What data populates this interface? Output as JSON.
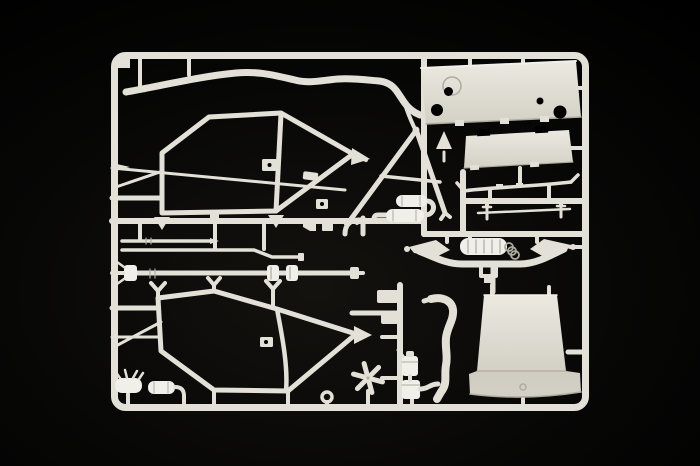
{
  "scene": {
    "type": "product-photograph",
    "description": "Injection-moulded model kit sprue (parts tree) in light ivory-grey styrene photographed on a black background; rounded rectangular runner frame with internal runners holding roll-cage frames, body panels, axle, driveshaft, exhaust and small fittings.",
    "colors": {
      "background": "#000000",
      "vignette": "#14120f",
      "plastic": "#e3e0d7",
      "plastic-bright": "#f1efe9",
      "plastic-dark": "#aeab9f",
      "panel-top": "#ebe9e0",
      "panel-bottom": "#d3d0c6",
      "skirt": "#cfccc2"
    },
    "frame": {
      "label": "Sprue runner frame with rounded corners"
    },
    "parts": [
      {
        "id": "roll-bar-tube",
        "label": "Long bent roll-bar tube along the top of the sprue"
      },
      {
        "id": "upper-roll-cage-side",
        "label": "Upper roll-cage side frame with three mounting feet and bracket plate"
      },
      {
        "id": "diagonal-brace-rod",
        "label": "Thin diagonal brace rod crossing the upper cage"
      },
      {
        "id": "a-frame-brace",
        "label": "A-shaped cage brace (inverted V) with cross strut and wedge"
      },
      {
        "id": "twin-cylinders",
        "label": "Two small cylindrical silencer/reservoir parts in the centre"
      },
      {
        "id": "firewall-panel",
        "label": "Large rectangular bulkhead panel with four round holes and moulded ring"
      },
      {
        "id": "floor-panel",
        "label": "Trapezoid floor panel with notched top edge"
      },
      {
        "id": "spoiler-strip",
        "label": "Thin aerofoil strip with upturned tips"
      },
      {
        "id": "tie-rod",
        "label": "Thin linkage rod with end droplink pins"
      },
      {
        "id": "ribbed-rod",
        "label": "Short ribbed straight rod"
      },
      {
        "id": "cranked-rod",
        "label": "Long cranked rod with offset end"
      },
      {
        "id": "drive-shaft",
        "label": "Long drive shaft with universal-joint couplings"
      },
      {
        "id": "small-brackets",
        "label": "Small angular bracket fittings on the centre runner"
      },
      {
        "id": "j-tube",
        "label": "Short J-bent tube"
      },
      {
        "id": "rear-axle",
        "label": "Rear axle assembly with spring perches, ribbed differential cylinder and coil"
      },
      {
        "id": "lower-roll-cage-side",
        "label": "Lower roll-cage side frame with mounting feet and arrow joint"
      },
      {
        "id": "exhaust-pipe",
        "label": "S-curved exhaust pipe"
      },
      {
        "id": "cooling-fan",
        "label": "Six-blade cooling fan"
      },
      {
        "id": "filter-cylinders",
        "label": "Two small canister parts (filter and reservoir)"
      },
      {
        "id": "small-mufflers",
        "label": "Two small silencer cylinders, one with hanger pins"
      },
      {
        "id": "tow-eyelet",
        "label": "Small tow eyelet ring"
      },
      {
        "id": "bonnet-panel",
        "label": "Large flared bonnet/rear panel with rivet detail"
      }
    ]
  }
}
